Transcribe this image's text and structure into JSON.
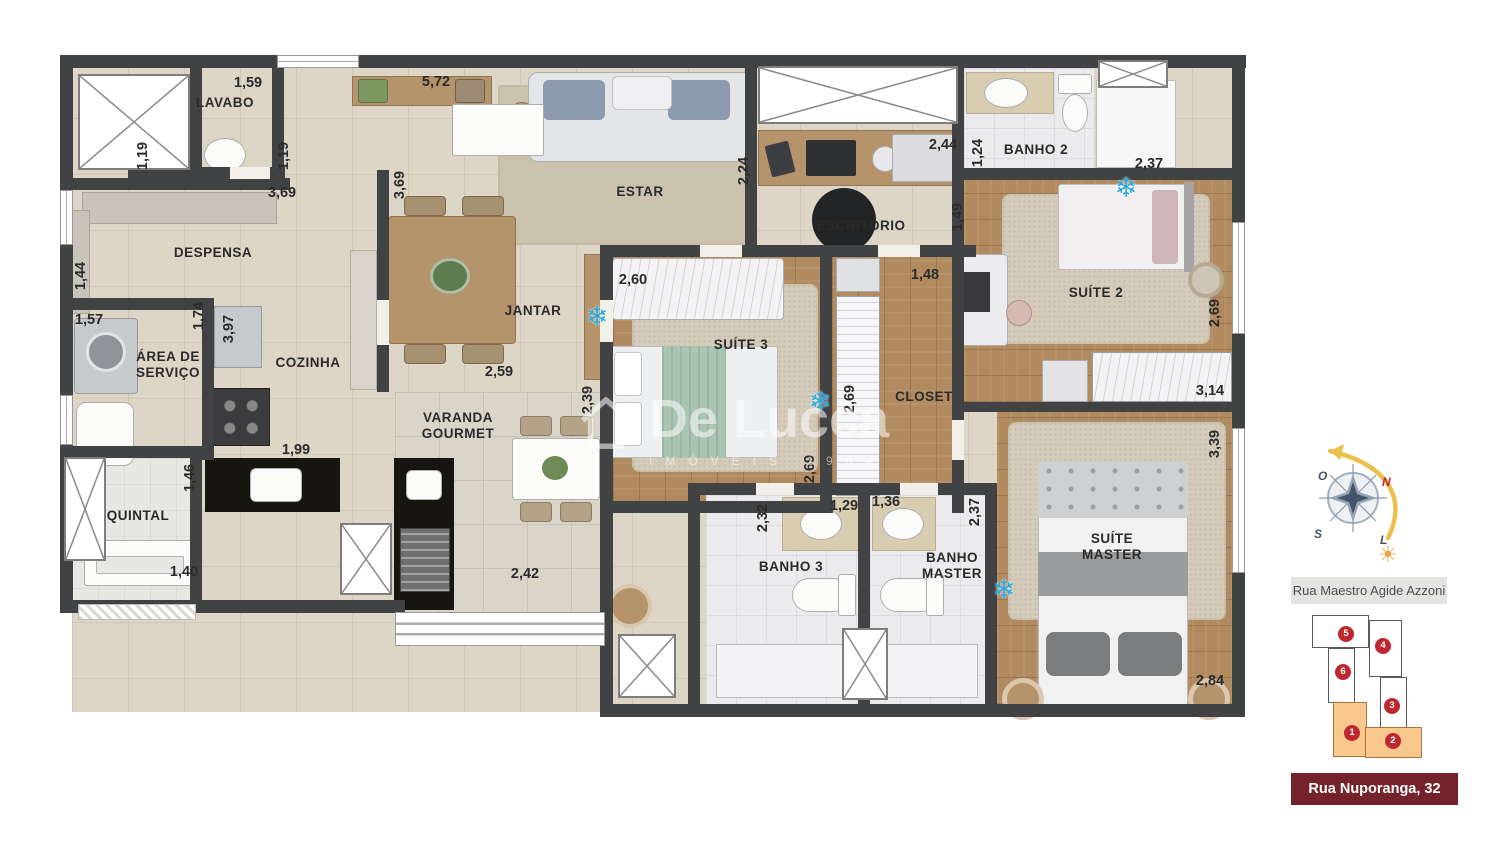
{
  "rooms": {
    "lavabo": "LAVABO",
    "despensa": "DESPENSA",
    "area_servico": "ÁREA DE\nSERVIÇO",
    "quintal": "QUINTAL",
    "cozinha": "COZINHA",
    "jantar": "JANTAR",
    "estar": "ESTAR",
    "escritorio": "ESCRITÓRIO",
    "varanda_gourmet": "VARANDA\nGOURMET",
    "suite3": "SUÍTE 3",
    "closet": "CLOSET",
    "suite2": "SUÍTE 2",
    "banho2": "BANHO 2",
    "banho3": "BANHO 3",
    "banho_master": "BANHO\nMASTER",
    "suite_master": "SUÍTE\nMASTER"
  },
  "dims": {
    "d119": "1,19",
    "d124": "1,24",
    "d129": "1,29",
    "d136": "1,36",
    "d140": "1,40",
    "d144": "1,44",
    "d146": "1,46",
    "d148": "1,48",
    "d149": "1,49",
    "d157": "1,57",
    "d159": "1,59",
    "d174": "1,74",
    "d199": "1,99",
    "d224": "2,24",
    "d232": "2,32",
    "d237": "2,37",
    "d239": "2,39",
    "d242": "2,42",
    "d244": "2,44",
    "d259": "2,59",
    "d260": "2,60",
    "d269": "2,69",
    "d284": "2,84",
    "d314": "3,14",
    "d339": "3,39",
    "d369": "3,69",
    "d397": "3,97",
    "d572": "5,72"
  },
  "icons": {
    "snowflake": "❄",
    "sun": "☀"
  },
  "watermark": {
    "name": "De Lucca",
    "tagline": "IMÓVEIS 1984"
  },
  "compass": {
    "north": "N",
    "south": "S",
    "east": "L",
    "west": "O"
  },
  "legend": {
    "street_top": "Rua Maestro Agide Azzoni",
    "street_bottom": "Rua Nuporanga, 32"
  },
  "keyplan": {
    "units": [
      {
        "n": "1",
        "highlighted": true
      },
      {
        "n": "2",
        "highlighted": true
      },
      {
        "n": "3",
        "highlighted": false
      },
      {
        "n": "4",
        "highlighted": false
      },
      {
        "n": "5",
        "highlighted": false
      },
      {
        "n": "6",
        "highlighted": false
      }
    ]
  },
  "colors": {
    "accent_red": "#bf2730",
    "maroon": "#74232d",
    "unit_highlight": "#f8c88d",
    "ac_blue": "#2aa9df",
    "wall": "#414243"
  }
}
